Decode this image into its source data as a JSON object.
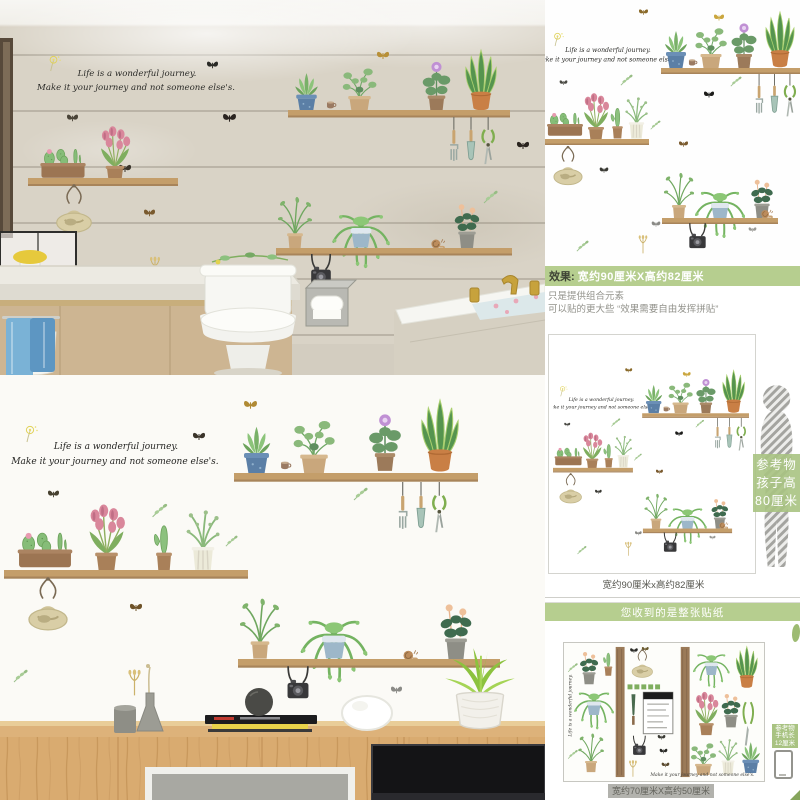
{
  "sticker": {
    "quote_line1": "Life is a wonderful journey.",
    "quote_line2": "Make it your journey and not someone else's."
  },
  "info": {
    "banner1_label": "效果:",
    "banner1_size": "宽约90厘米X高约82厘米",
    "note_line1": "只是提供组合元素",
    "note_line2": "可以贴的更大些 “效果需要自由发挥拼贴”",
    "layout_caption": "宽约90厘米x高约82厘米",
    "banner2_text": "您收到的是整张贴纸",
    "sheet_caption": "宽约70厘米X高约50厘米",
    "child_ref_line1": "参考物",
    "child_ref_line2": "孩子高",
    "child_ref_line3": "80厘米",
    "phone_ref_line1": "参考物",
    "phone_ref_line2": "手机长",
    "phone_ref_line3": "12厘米"
  },
  "colors": {
    "accent_green": "#b6ce8f",
    "label_green": "#a9c382",
    "shelf_wood": "#c49e6a",
    "desk_wood": "#d9ab70",
    "caption_grey": "#b2b2ad"
  }
}
